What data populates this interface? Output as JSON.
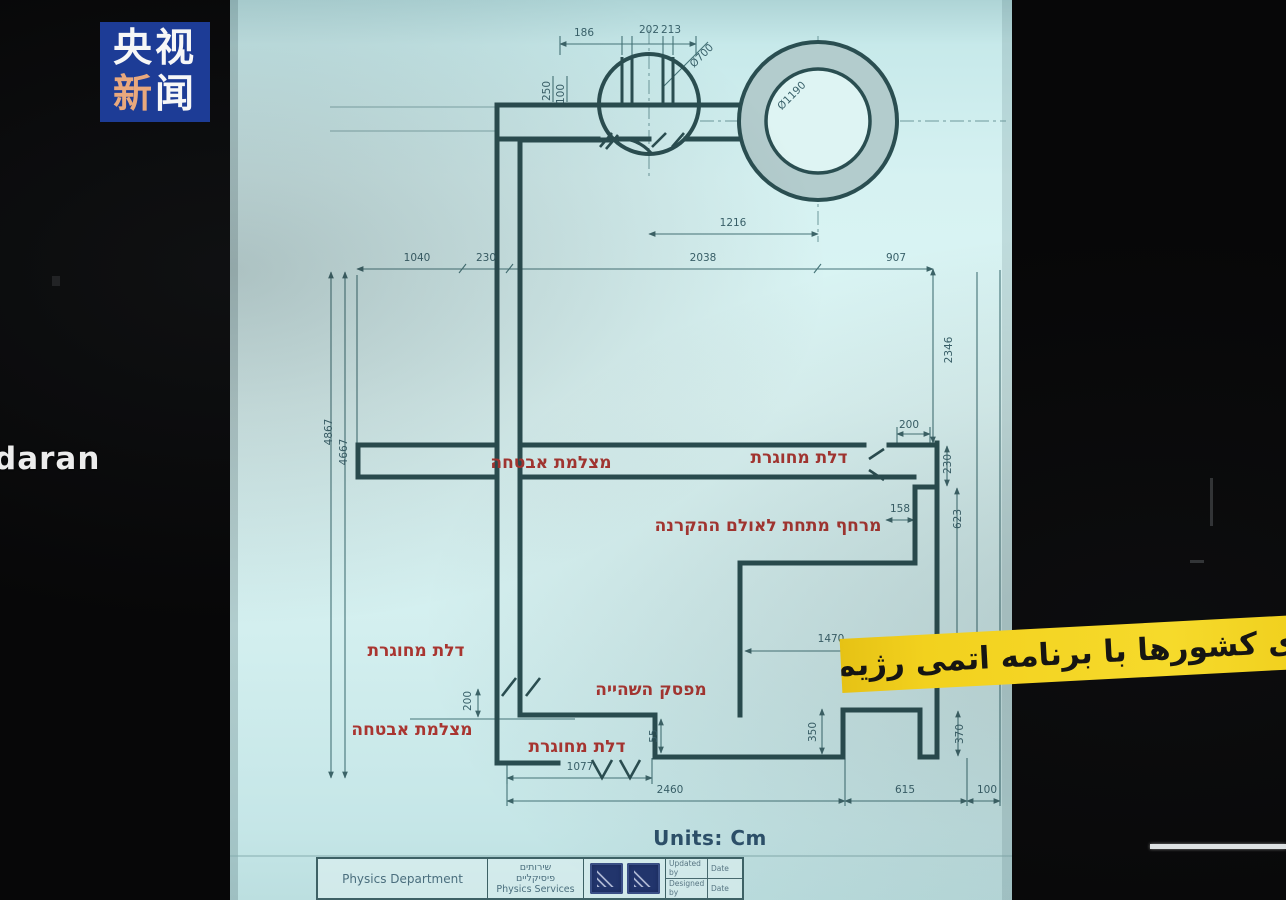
{
  "logo": {
    "line1": "央视",
    "char_xin": "新",
    "char_wen": "闻"
  },
  "overlay": {
    "left_partial_text": "daran",
    "banner_text": "ی کشورها با برنامه اتمی رژیم صهیونیستی"
  },
  "drawing": {
    "units_label": "Units: Cm",
    "annotations": [
      {
        "text": "מצלמת אבטחה",
        "x": 551,
        "y": 468
      },
      {
        "text": "דלת  מחוגרת",
        "x": 799,
        "y": 463
      },
      {
        "text": "מרחף מתחת לאולם ההקרנה",
        "x": 768,
        "y": 531
      },
      {
        "text": "דלת מחוגרת",
        "x": 416,
        "y": 656
      },
      {
        "text": "מפסק השהייה",
        "x": 651,
        "y": 695
      },
      {
        "text": "מצלמת אבטחה",
        "x": 412,
        "y": 735
      },
      {
        "text": "דלת מחוגרת",
        "x": 577,
        "y": 752
      }
    ],
    "dimensions": [
      {
        "text": "186",
        "x": 584,
        "y": 36,
        "rot": 0
      },
      {
        "text": "202",
        "x": 649,
        "y": 33,
        "rot": 0
      },
      {
        "text": "213",
        "x": 671,
        "y": 33,
        "rot": 0
      },
      {
        "text": "Ø700",
        "x": 704,
        "y": 58,
        "rot": -45
      },
      {
        "text": "250",
        "x": 550,
        "y": 91,
        "rot": -90
      },
      {
        "text": "100",
        "x": 564,
        "y": 94,
        "rot": -90
      },
      {
        "text": "Ø1190",
        "x": 794,
        "y": 98,
        "rot": -45
      },
      {
        "text": "1216",
        "x": 733,
        "y": 226,
        "rot": 0
      },
      {
        "text": "1040",
        "x": 417,
        "y": 261,
        "rot": 0
      },
      {
        "text": "230",
        "x": 486,
        "y": 261,
        "rot": 0
      },
      {
        "text": "2038",
        "x": 703,
        "y": 261,
        "rot": 0
      },
      {
        "text": "907",
        "x": 896,
        "y": 261,
        "rot": 0
      },
      {
        "text": "2346",
        "x": 952,
        "y": 350,
        "rot": -90
      },
      {
        "text": "4867",
        "x": 332,
        "y": 432,
        "rot": -90
      },
      {
        "text": "4667",
        "x": 347,
        "y": 452,
        "rot": -90
      },
      {
        "text": "200",
        "x": 909,
        "y": 428,
        "rot": 0
      },
      {
        "text": "230",
        "x": 951,
        "y": 464,
        "rot": -90
      },
      {
        "text": "158",
        "x": 900,
        "y": 512,
        "rot": 0
      },
      {
        "text": "623",
        "x": 961,
        "y": 519,
        "rot": -90
      },
      {
        "text": "1470",
        "x": 831,
        "y": 642,
        "rot": 0
      },
      {
        "text": "200",
        "x": 471,
        "y": 701,
        "rot": -90
      },
      {
        "text": "55",
        "x": 657,
        "y": 736,
        "rot": -90
      },
      {
        "text": "350",
        "x": 816,
        "y": 732,
        "rot": -90
      },
      {
        "text": "370",
        "x": 963,
        "y": 734,
        "rot": -90
      },
      {
        "text": "1077",
        "x": 580,
        "y": 770,
        "rot": 0
      },
      {
        "text": "2460",
        "x": 670,
        "y": 793,
        "rot": 0
      },
      {
        "text": "615",
        "x": 905,
        "y": 793,
        "rot": 0
      },
      {
        "text": "100",
        "x": 987,
        "y": 793,
        "rot": 0
      }
    ],
    "title_block": {
      "dept": "Physics Department",
      "services_he_1": "שירותים",
      "services_he_2": "פיסיקליים",
      "services_en": "Physics Services",
      "updated_by": "Updated by",
      "designed_by": "Designed by",
      "date": "Date"
    }
  }
}
